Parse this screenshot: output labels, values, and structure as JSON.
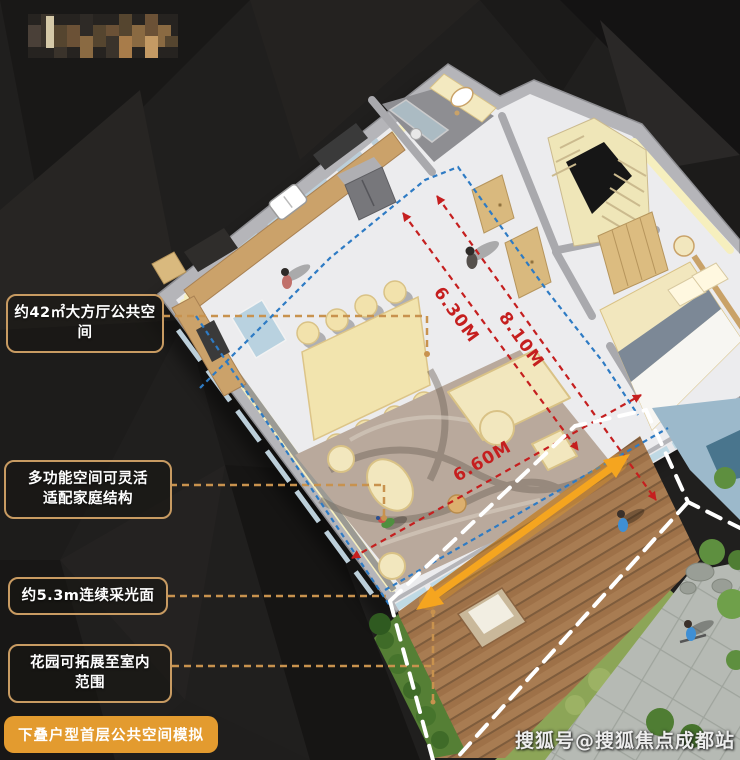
{
  "scene": {
    "background_color": "#201F1E",
    "watermark": "搜狐号@搜狐焦点成都站",
    "caption": {
      "label": "下叠户型首层公共空间模拟",
      "bg_color": "#E39B2F"
    }
  },
  "callouts": [
    {
      "id": "living-area",
      "line1": "约42㎡大方厅公共空间",
      "line2": ""
    },
    {
      "id": "flex-space",
      "line1": "多功能空间可灵活",
      "line2": "适配家庭结构"
    },
    {
      "id": "daylight",
      "line1": "约5.3m连续采光面",
      "line2": ""
    },
    {
      "id": "garden",
      "line1": "花园可拓展至室内",
      "line2": "范围"
    }
  ],
  "dimensions": {
    "depth1": "6.30M",
    "depth2": "8.10M",
    "width": "6.60M"
  },
  "style": {
    "callout_border": "#C89B62",
    "leader_color": "#C8924E",
    "dimension_color": "#C51F1F",
    "path_color": "#2E7BC4",
    "highlight_arrow": "#F5A51F",
    "outline_color": "#FFFFFF"
  }
}
